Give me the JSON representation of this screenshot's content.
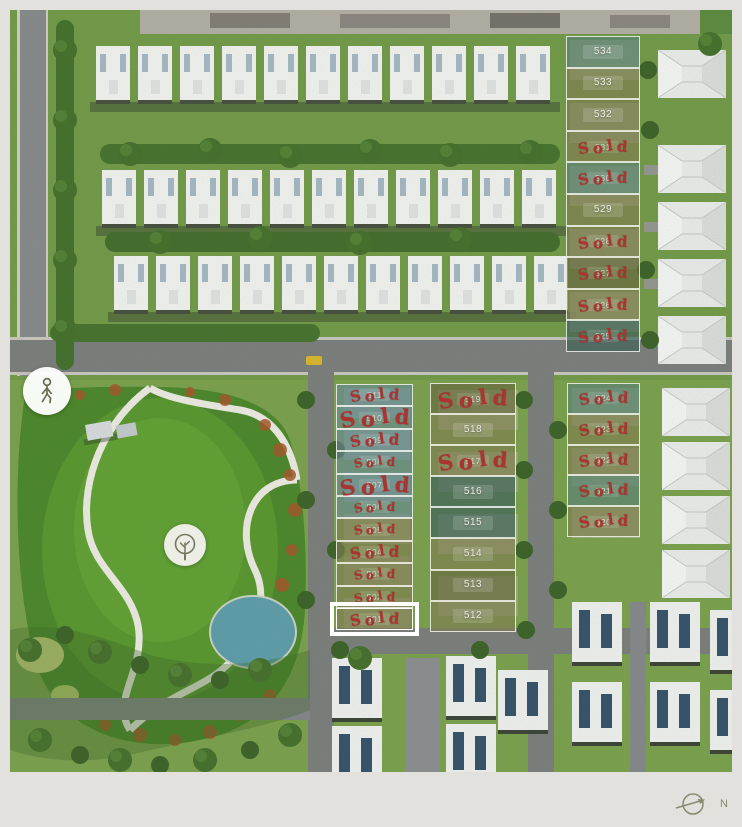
{
  "canvas": {
    "background": "#e3e1de"
  },
  "compass": {
    "label": "N",
    "color": "#8a8871",
    "icon": "compass-arrow-icon"
  },
  "map_markers": [
    {
      "icon": "pedestrian-icon",
      "meaning": "walking-distance-marker"
    },
    {
      "icon": "park-tree-icon",
      "meaning": "park-marker"
    }
  ],
  "stamp": {
    "text": "Sold",
    "color": "#a93431"
  },
  "lot_groups": [
    {
      "id": "west-column",
      "x": 326,
      "y": 374,
      "width": 77,
      "row_height": 22.4,
      "lots": [
        {
          "number": "511",
          "sold": true,
          "tint": "blue",
          "stamp_size": "md"
        },
        {
          "number": "510",
          "sold": true,
          "tint": "blue",
          "stamp_size": "lg"
        },
        {
          "number": "509",
          "sold": true,
          "tint": "blue",
          "stamp_size": "md"
        },
        {
          "number": "508",
          "sold": true,
          "tint": "blue",
          "stamp_size": "sm"
        },
        {
          "number": "507",
          "sold": true,
          "tint": "blue",
          "stamp_size": "lg"
        },
        {
          "number": "506",
          "sold": true,
          "tint": "blue",
          "stamp_size": "sm"
        },
        {
          "number": "505",
          "sold": true,
          "tint": "olive",
          "stamp_size": "sm"
        },
        {
          "number": "504",
          "sold": true,
          "tint": "olive",
          "stamp_size": "md"
        },
        {
          "number": "503",
          "sold": true,
          "tint": "olive",
          "stamp_size": "sm"
        },
        {
          "number": "502",
          "sold": true,
          "tint": "olive",
          "stamp_size": "sm"
        },
        {
          "number": "501",
          "sold": true,
          "tint": "olive",
          "stamp_size": "md",
          "highlighted": true
        }
      ]
    },
    {
      "id": "middle-column",
      "x": 420,
      "y": 373,
      "width": 86,
      "row_height": 31.1,
      "lots": [
        {
          "number": "519",
          "sold": true,
          "tint": "olive-dark",
          "stamp_size": "lg"
        },
        {
          "number": "518",
          "sold": false,
          "tint": "olive"
        },
        {
          "number": "517",
          "sold": true,
          "tint": "olive",
          "stamp_size": "lg"
        },
        {
          "number": "516",
          "sold": false,
          "tint": "teal-dark"
        },
        {
          "number": "515",
          "sold": false,
          "tint": "teal-dark"
        },
        {
          "number": "514",
          "sold": false,
          "tint": "olive"
        },
        {
          "number": "513",
          "sold": false,
          "tint": "olive-dark"
        },
        {
          "number": "512",
          "sold": false,
          "tint": "olive"
        }
      ]
    },
    {
      "id": "east-upper-column",
      "x": 556,
      "y": 26,
      "width": 74,
      "row_height": 31.6,
      "lots": [
        {
          "number": "534",
          "sold": false,
          "tint": "teal"
        },
        {
          "number": "533",
          "sold": false,
          "tint": "olive"
        },
        {
          "number": "532",
          "sold": false,
          "tint": "olive"
        },
        {
          "number": "531",
          "sold": true,
          "tint": "olive",
          "stamp_size": "md"
        },
        {
          "number": "530",
          "sold": true,
          "tint": "teal",
          "stamp_size": "md"
        },
        {
          "number": "529",
          "sold": false,
          "tint": "olive"
        },
        {
          "number": "528",
          "sold": true,
          "tint": "olive",
          "stamp_size": "md"
        },
        {
          "number": "527",
          "sold": true,
          "tint": "olive-dark",
          "stamp_size": "md"
        },
        {
          "number": "526",
          "sold": true,
          "tint": "olive",
          "stamp_size": "md"
        },
        {
          "number": "525",
          "sold": true,
          "tint": "teal-dark",
          "stamp_size": "md"
        }
      ]
    },
    {
      "id": "east-lower-column",
      "x": 557,
      "y": 373,
      "width": 73,
      "row_height": 30.8,
      "lots": [
        {
          "number": "524",
          "sold": true,
          "tint": "teal",
          "stamp_size": "md"
        },
        {
          "number": "523",
          "sold": true,
          "tint": "olive",
          "stamp_size": "md"
        },
        {
          "number": "522",
          "sold": true,
          "tint": "olive",
          "stamp_size": "md"
        },
        {
          "number": "521",
          "sold": true,
          "tint": "teal",
          "stamp_size": "md"
        },
        {
          "number": "520",
          "sold": true,
          "tint": "olive",
          "stamp_size": "md"
        }
      ]
    }
  ]
}
